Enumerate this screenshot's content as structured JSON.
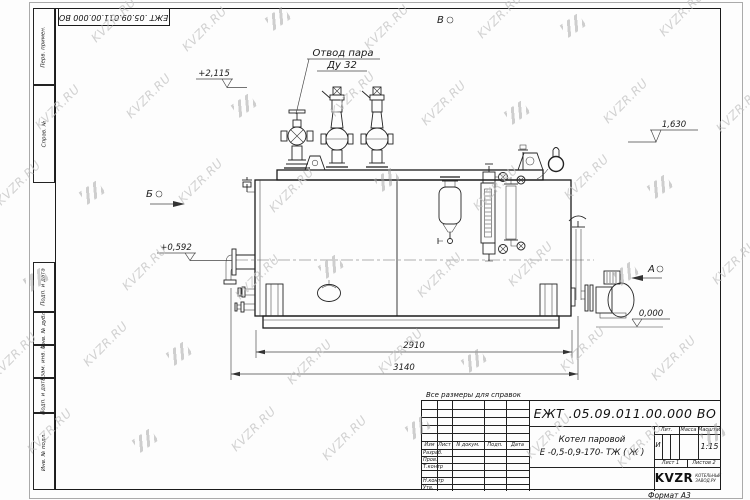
{
  "watermark": {
    "text": "KVZR.RU"
  },
  "frame": {
    "top_stamp": "ЕЖТ .05.09.011.00.000  ВО",
    "side_columns": [
      {
        "label": "Перв. примен."
      },
      {
        "label": "Справ. №"
      },
      {
        "label": "Подп. и дата"
      },
      {
        "label": "Инв. № дубл."
      },
      {
        "label": "Взам. инв. №"
      },
      {
        "label": "Подп. и дата"
      },
      {
        "label": "Инв. № подл."
      }
    ]
  },
  "drawing": {
    "callout": {
      "line1": "Отвод пара",
      "line2": "Ду 32"
    },
    "view_markers": {
      "top": "В",
      "left": "Б",
      "right": "А"
    },
    "elevations": {
      "valves_top": "+2,115",
      "shell_top": "1,630",
      "axis": "+0,592",
      "ground": "0,000"
    },
    "dimensions": {
      "shell_length": "2910",
      "overall_length": "3140"
    }
  },
  "note": "Все размеры для справок",
  "title_block": {
    "designation": "ЕЖТ .05.09.011.00.000  ВО",
    "product_name": "Котел паровой",
    "product_code": "Е -0,5-0,9-170- ТЖ ( Ж )",
    "header_cols": [
      "Изм",
      "Лист",
      "N докум.",
      "Подп.",
      "Дата"
    ],
    "sign_rows": [
      "Разраб.",
      "Пров.",
      "Т.контр",
      "",
      "Н.контр",
      "Утв."
    ],
    "lit_label": "Лит.",
    "lit_value": "И",
    "mass_label": "Масса",
    "scale_label": "Масштаб",
    "scale_value": "1:15",
    "sheet_label": "Лист",
    "sheet_value": "1",
    "sheets_label": "Листов",
    "sheets_value": "2",
    "logo_word": "KVZR",
    "logo_caption_line1": "КОТЕЛЬНЫЙ",
    "logo_caption_line2": "ЗАВОД.РУ",
    "format_label": "Формат А3"
  }
}
